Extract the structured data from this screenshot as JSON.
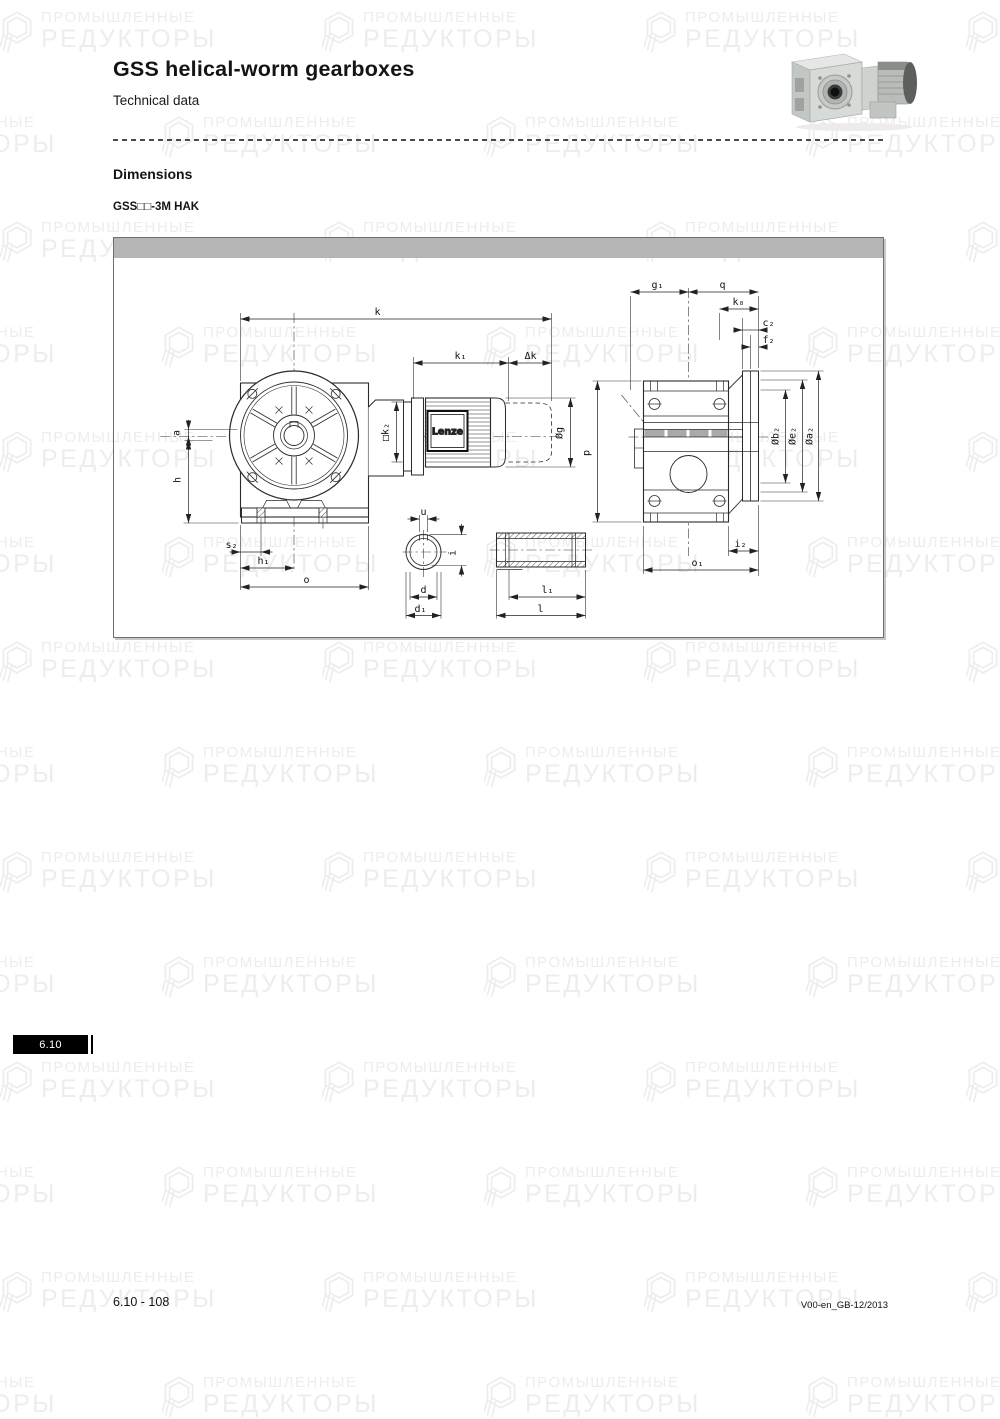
{
  "header": {
    "title": "GSS helical-worm gearboxes",
    "subtitle": "Technical data"
  },
  "section": {
    "heading": "Dimensions",
    "variant": "GSS□□-3M HAK"
  },
  "drawing": {
    "brand": "Lenze",
    "labels": {
      "k": "k",
      "k1": "k₁",
      "dk": "Δk",
      "a": "a",
      "h": "h",
      "s2": "s₂",
      "h1": "h₁",
      "o": "o",
      "k2": "□k₂",
      "g": "Øg",
      "p": "p",
      "g1": "g₁",
      "q": "q",
      "k8": "k₈",
      "c2": "c₂",
      "f2": "f₂",
      "b2": "Øb₂",
      "e2": "Øe₂",
      "a2": "Øa₂",
      "i2": "i₂",
      "o1": "o₁",
      "u": "u",
      "i": "i",
      "d": "d",
      "d1": "d₁",
      "l1": "l₁",
      "l": "l"
    }
  },
  "watermark": {
    "line1": "ПРОМЫШЛЕННЫЕ",
    "line2": "РЕДУКТОРЫ",
    "color": "#ededed"
  },
  "footer": {
    "page": "6.10 - 108",
    "code": "V00-en_GB-12/2013",
    "tab": "6.10"
  }
}
